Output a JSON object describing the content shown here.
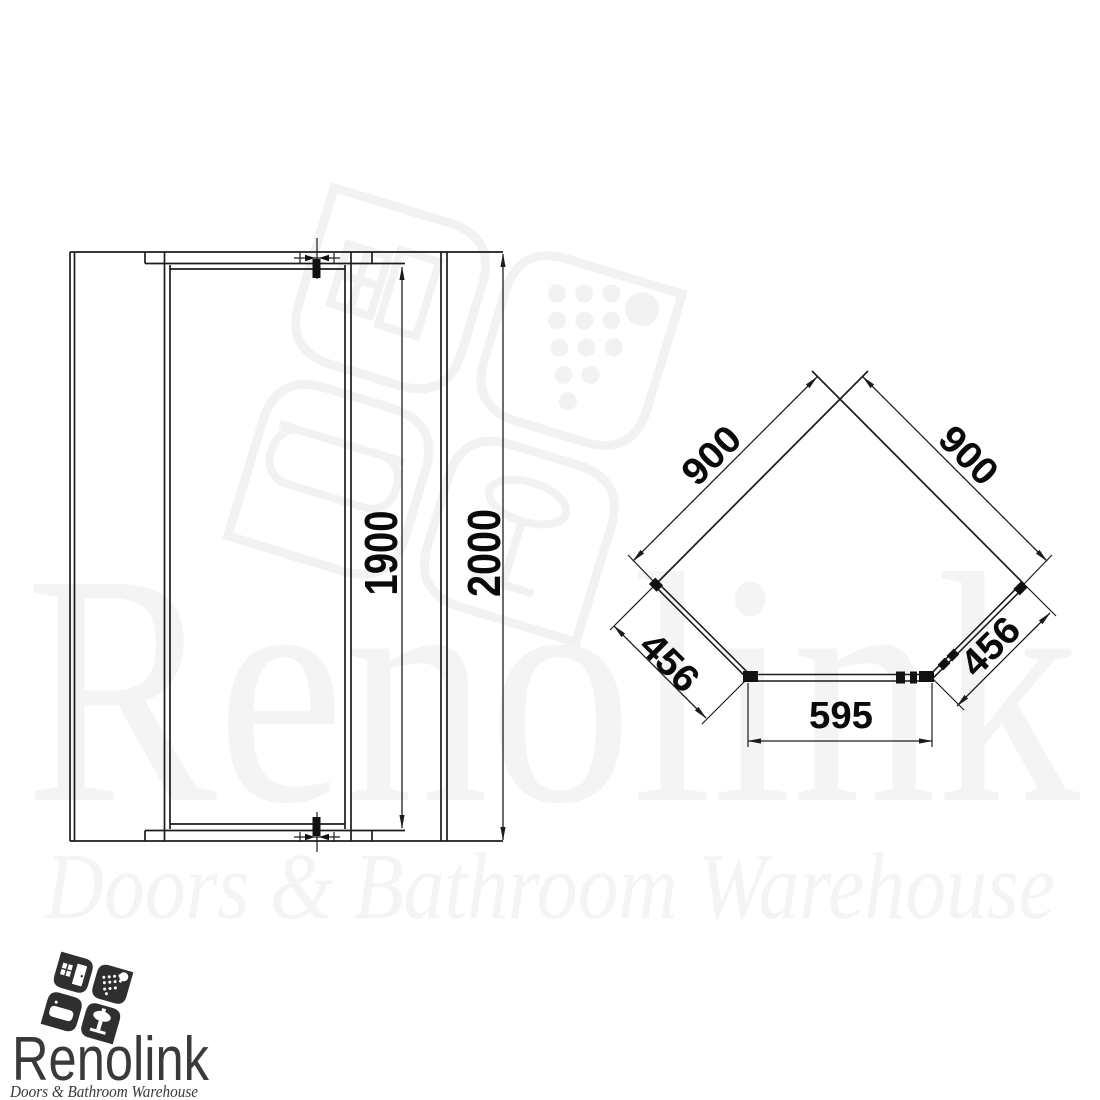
{
  "front_elevation": {
    "door_height": "1900",
    "overall_height": "2000"
  },
  "plan_view": {
    "left_wall": "900",
    "right_wall": "900",
    "left_panel": "456",
    "right_panel": "456",
    "front_width": "595"
  },
  "watermark": {
    "brand": "Renolink",
    "tagline": "Doors & Bathroom Warehouse"
  },
  "logo": {
    "brand": "Renolink",
    "tagline": "Doors & Bathroom Warehouse"
  },
  "colors": {
    "line": "#1c1c1c",
    "watermark": "#f2f2f2",
    "logo_text": "#3a3a3a"
  }
}
